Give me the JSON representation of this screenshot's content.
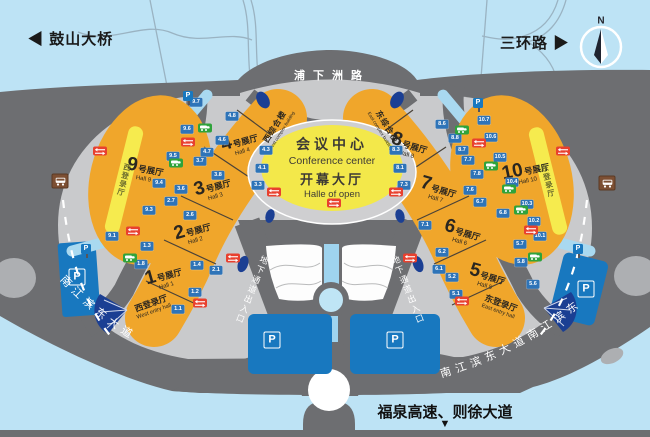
{
  "top": {
    "left_arrow": "◀",
    "left_road": "鼓山大桥",
    "right_road": "三环路",
    "right_arrow": "▶",
    "compass_n": "N"
  },
  "roads": {
    "top_center": "浦下洲路",
    "riverside_left": "南江滨东大道",
    "riverside_right": "南江滨东大道南江滨东",
    "underpass_left": "地下通道出入口",
    "underpass_right": "地下通道出入口",
    "bottom_highway": "福泉高速、则徐大道",
    "bottom_arrow": "▼"
  },
  "conference": {
    "title": "会议中心",
    "title_en": "Conference center",
    "hall": "开幕大厅",
    "hall_en": "Halle of open"
  },
  "halls": [
    {
      "num": "1",
      "suffix": "号展厅",
      "en": "Hall 1"
    },
    {
      "num": "2",
      "suffix": "号展厅",
      "en": "Hall 2"
    },
    {
      "num": "3",
      "suffix": "号展厅",
      "en": "Hall 3"
    },
    {
      "num": "4",
      "suffix": "号展厅",
      "en": "Hall 4"
    },
    {
      "num": "5",
      "suffix": "号展厅",
      "en": "Hall 5"
    },
    {
      "num": "6",
      "suffix": "号展厅",
      "en": "Hall 6"
    },
    {
      "num": "7",
      "suffix": "号展厅",
      "en": "Hall 7"
    },
    {
      "num": "8",
      "suffix": "号展厅",
      "en": "Hall 8"
    },
    {
      "num": "9",
      "suffix": "号展厅",
      "en": "Hall 9"
    },
    {
      "num": "10",
      "suffix": "号展厅",
      "en": "Hall 10"
    }
  ],
  "entry_halls": {
    "west": {
      "label": "西登录厅",
      "en": "West entry hall"
    },
    "east": {
      "label": "东登录厅",
      "en": "East entry hall"
    },
    "west_strip": "西登录厅",
    "east_strip": "东登录厅"
  },
  "complex": {
    "west": "西综合楼",
    "west_en": "West complex building",
    "east": "东综合楼",
    "east_en": "East complex building"
  },
  "parking_label": "P",
  "gates": [
    {
      "label": "9.7",
      "x": 196,
      "y": 102
    },
    {
      "label": "9.6",
      "x": 187,
      "y": 129
    },
    {
      "label": "9.5",
      "x": 173,
      "y": 156
    },
    {
      "label": "9.4",
      "x": 159,
      "y": 183
    },
    {
      "label": "9.3",
      "x": 149,
      "y": 210
    },
    {
      "label": "9.1",
      "x": 112,
      "y": 236
    },
    {
      "label": "4.8",
      "x": 232,
      "y": 116
    },
    {
      "label": "4.6",
      "x": 222,
      "y": 140
    },
    {
      "label": "4.7",
      "x": 207,
      "y": 152
    },
    {
      "label": "3.7",
      "x": 200,
      "y": 161
    },
    {
      "label": "3.8",
      "x": 218,
      "y": 175
    },
    {
      "label": "3.6",
      "x": 181,
      "y": 189
    },
    {
      "label": "2.7",
      "x": 171,
      "y": 201
    },
    {
      "label": "2.6",
      "x": 190,
      "y": 215
    },
    {
      "label": "2.1",
      "x": 216,
      "y": 270
    },
    {
      "label": "1.4",
      "x": 197,
      "y": 265
    },
    {
      "label": "1.3",
      "x": 147,
      "y": 246
    },
    {
      "label": "1.8",
      "x": 141,
      "y": 264
    },
    {
      "label": "1.2",
      "x": 195,
      "y": 292
    },
    {
      "label": "1.1",
      "x": 178,
      "y": 309
    },
    {
      "label": "4.3",
      "x": 266,
      "y": 150
    },
    {
      "label": "4.1",
      "x": 262,
      "y": 168
    },
    {
      "label": "3.3",
      "x": 258,
      "y": 185
    },
    {
      "label": "8.3",
      "x": 396,
      "y": 150
    },
    {
      "label": "8.1",
      "x": 400,
      "y": 168
    },
    {
      "label": "7.3",
      "x": 404,
      "y": 185
    },
    {
      "label": "8.6",
      "x": 442,
      "y": 124
    },
    {
      "label": "8.8",
      "x": 455,
      "y": 138
    },
    {
      "label": "8.7",
      "x": 462,
      "y": 150
    },
    {
      "label": "7.7",
      "x": 468,
      "y": 160
    },
    {
      "label": "7.8",
      "x": 477,
      "y": 174
    },
    {
      "label": "7.6",
      "x": 470,
      "y": 190
    },
    {
      "label": "6.7",
      "x": 480,
      "y": 202
    },
    {
      "label": "6.8",
      "x": 503,
      "y": 213
    },
    {
      "label": "7.1",
      "x": 425,
      "y": 225
    },
    {
      "label": "6.2",
      "x": 442,
      "y": 252
    },
    {
      "label": "6.1",
      "x": 439,
      "y": 269
    },
    {
      "label": "5.2",
      "x": 452,
      "y": 277
    },
    {
      "label": "5.1",
      "x": 456,
      "y": 294
    },
    {
      "label": "5.7",
      "x": 520,
      "y": 244
    },
    {
      "label": "5.8",
      "x": 521,
      "y": 262
    },
    {
      "label": "5.6",
      "x": 533,
      "y": 284
    },
    {
      "label": "10.7",
      "x": 484,
      "y": 120
    },
    {
      "label": "10.6",
      "x": 491,
      "y": 137
    },
    {
      "label": "10.5",
      "x": 500,
      "y": 157
    },
    {
      "label": "10.4",
      "x": 512,
      "y": 182
    },
    {
      "label": "10.3",
      "x": 527,
      "y": 204
    },
    {
      "label": "10.2",
      "x": 534,
      "y": 221
    },
    {
      "label": "10.1",
      "x": 540,
      "y": 236
    }
  ],
  "icons": {
    "shuttle_green": [
      [
        205,
        128
      ],
      [
        176,
        163
      ],
      [
        130,
        258
      ],
      [
        462,
        130
      ],
      [
        491,
        166
      ],
      [
        509,
        189
      ],
      [
        521,
        210
      ],
      [
        535,
        257
      ]
    ],
    "gate_red": [
      [
        188,
        142
      ],
      [
        133,
        231
      ],
      [
        233,
        258
      ],
      [
        274,
        192
      ],
      [
        334,
        203
      ],
      [
        396,
        192
      ],
      [
        100,
        151
      ],
      [
        200,
        303
      ],
      [
        479,
        143
      ],
      [
        563,
        151
      ],
      [
        531,
        230
      ],
      [
        410,
        258
      ],
      [
        462,
        301
      ]
    ],
    "bus_stop": [
      [
        60,
        181
      ],
      [
        607,
        183
      ]
    ],
    "parking_sign": [
      [
        188,
        96
      ],
      [
        478,
        103
      ],
      [
        86,
        249
      ],
      [
        578,
        249
      ]
    ],
    "parking_lot_p": [
      [
        77,
        277
      ],
      [
        272,
        340
      ],
      [
        395,
        340
      ],
      [
        586,
        289
      ]
    ]
  },
  "colors": {
    "background": "#BDE3F5",
    "road": "#6D6E71",
    "plaza": "#C9CACC",
    "hall_orange": "#F0A62B",
    "dome_yellow": "#F3E84A",
    "strip_yellow": "#F6EB4E",
    "parking_blue": "#1878BF",
    "gate_tag_blue": "#2E74B8",
    "navy": "#1B3F93",
    "shuttle_green": "#2FA33B",
    "gate_red": "#E8402E",
    "bus_brown": "#7C4F33"
  }
}
